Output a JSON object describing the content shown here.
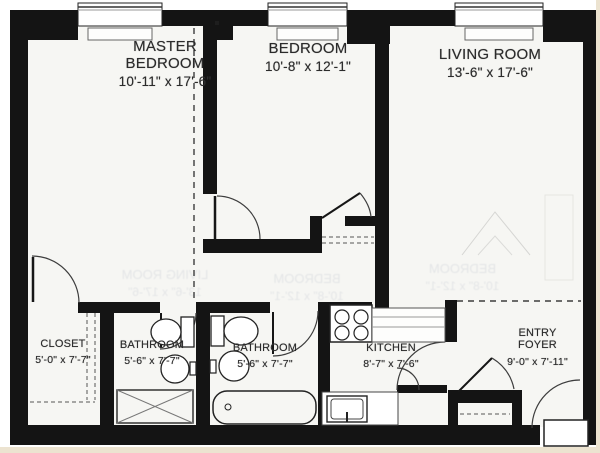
{
  "plan_title": "Apartment floor plan",
  "rooms": {
    "master_bedroom": {
      "name_line1": "MASTER",
      "name_line2": "BEDROOM",
      "dims": "10'-11\" x 17'-6\""
    },
    "bedroom": {
      "name_line1": "BEDROOM",
      "dims": "10'-8\" x 12'-1\""
    },
    "living_room": {
      "name_line1": "LIVING ROOM",
      "dims": "13'-6\" x 17'-6\""
    },
    "closet": {
      "name_line1": "CLOSET",
      "dims": "5'-0\" x 7'-7\""
    },
    "bathroom_1": {
      "name_line1": "BATHROOM",
      "dims": "5'-6\" x 7'-7\""
    },
    "bathroom_2": {
      "name_line1": "BATHROOM",
      "dims": "5'-6\" x 7'-7\""
    },
    "kitchen": {
      "name_line1": "KITCHEN",
      "dims": "8'-7\" x 7'-6\""
    },
    "entry_foyer": {
      "name_line1": "ENTRY",
      "name_line2": "FOYER",
      "dims": "9'-0\" x 7'-11\""
    }
  },
  "colors": {
    "wall": "#141414",
    "floor": "#f6f6f3",
    "paper_trim": "#ece3d0",
    "line": "#3d3d3d"
  }
}
